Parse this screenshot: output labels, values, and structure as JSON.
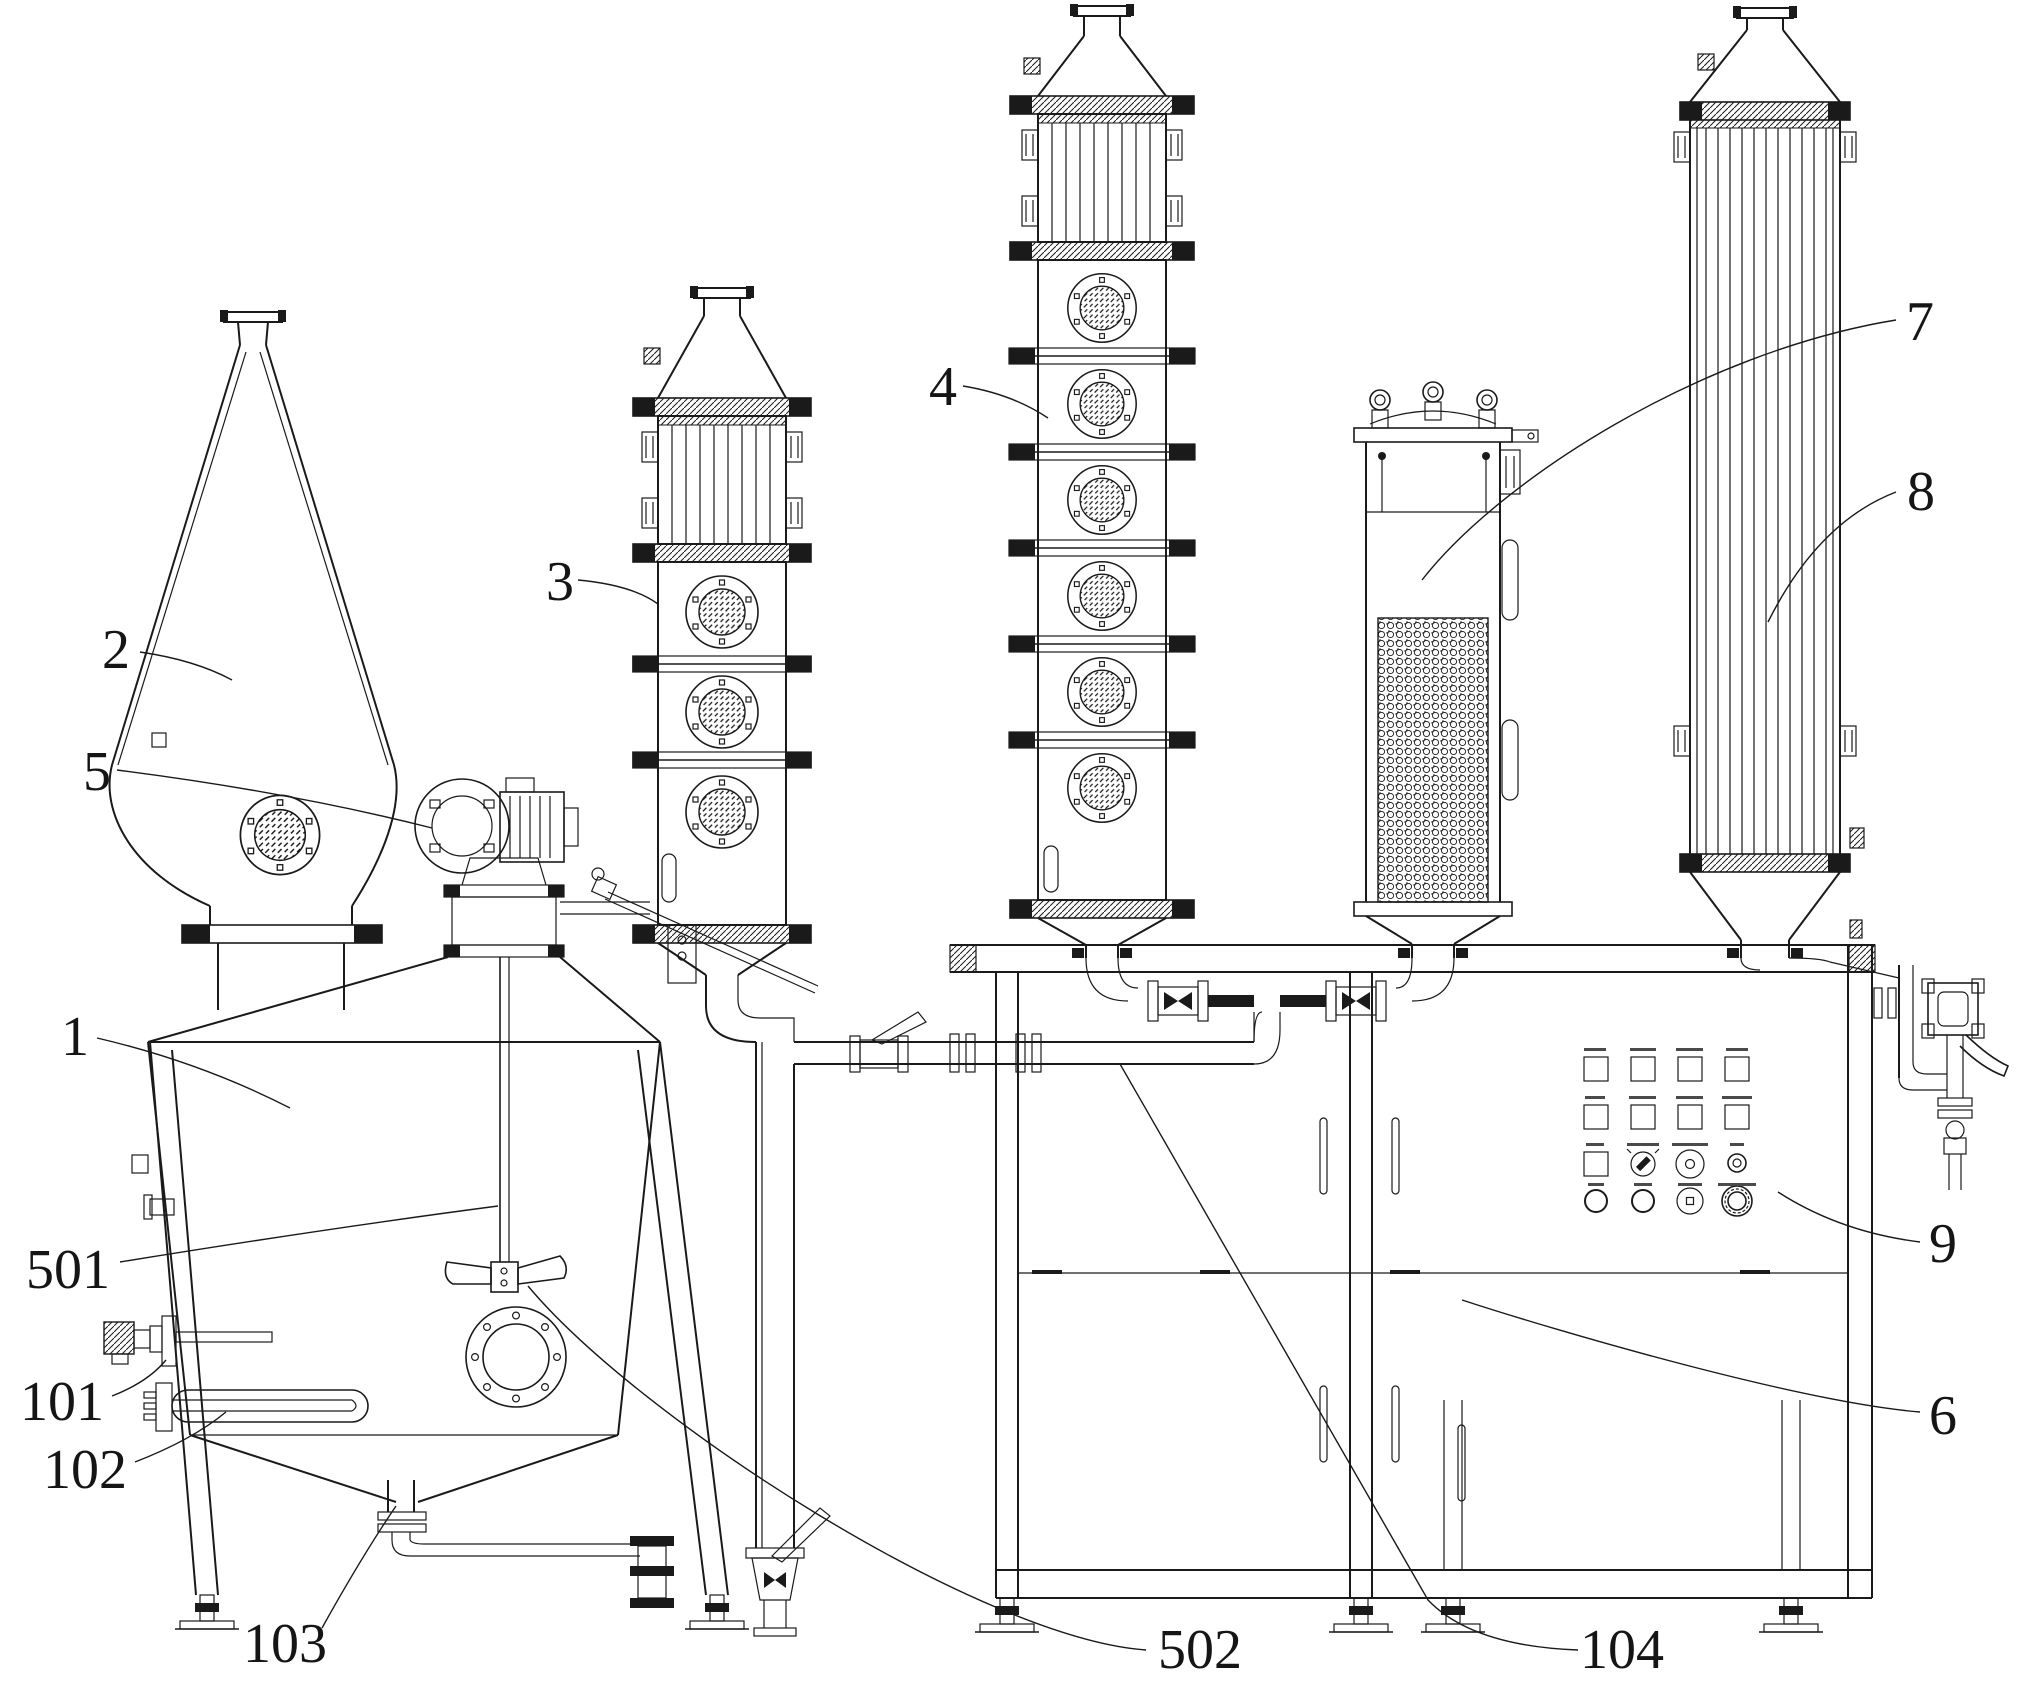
{
  "page": {
    "background": "#ffffff",
    "ink_color": "#1a1a1a",
    "type": "patent-style equipment line drawing"
  },
  "labels": {
    "n1": "1",
    "n2": "2",
    "n3": "3",
    "n4": "4",
    "n5": "5",
    "n6": "6",
    "n7": "7",
    "n8": "8",
    "n9": "9",
    "n101": "101",
    "n102": "102",
    "n103": "103",
    "n104": "104",
    "n501": "501",
    "n502": "502"
  },
  "callout_targets": {
    "1": "large mixing tank body",
    "2": "conical hopper vessel",
    "3": "short sight-glass column (3 portholes)",
    "4": "tall sight-glass column (6 portholes)",
    "5": "agitator gear motor",
    "6": "cabinet frame",
    "7": "packed filter cartridge vessel",
    "8": "tubular condenser column",
    "9": "control panel",
    "101": "thermowell sensor on tank wall",
    "102": "heating element on tank wall",
    "103": "tank bottom drain pipe",
    "104": "under-table manifold pipe",
    "501": "agitator shaft",
    "502": "agitator impeller"
  },
  "control_panel": {
    "rows": 4,
    "square_buttons": 9,
    "round_buttons": 4,
    "rotary_switch": 1,
    "dial_indicators": 2,
    "emergency_stop": 1,
    "caption_marks": 16
  },
  "structure": {
    "portholes_column_3": 3,
    "portholes_column_4": 6,
    "funnel_porthole": 1,
    "filter_lifting_eyes": 3,
    "cabinet_door_handle_slots": 5
  }
}
